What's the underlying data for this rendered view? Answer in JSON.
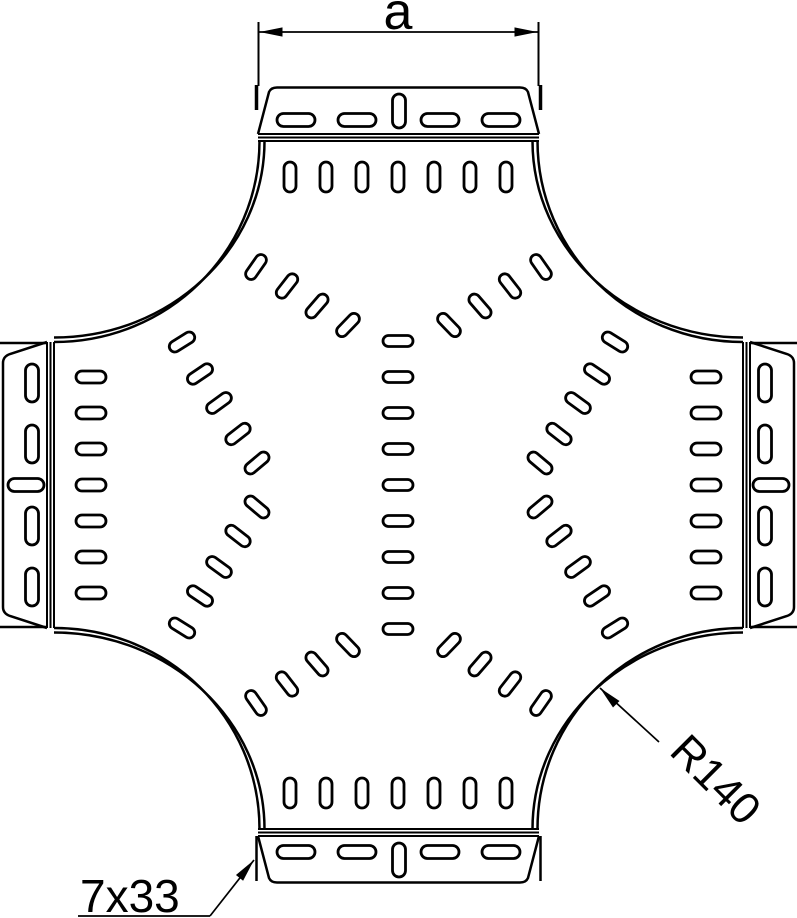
{
  "drawing": {
    "title": "cable-tray-cross-piece-top-view",
    "canvas": {
      "width": 797,
      "height": 918,
      "background": "#ffffff",
      "ink": "#000000"
    },
    "labels": {
      "dim_a": {
        "text": "a",
        "x": 398,
        "y": 29,
        "size": 52,
        "rotate": 0,
        "anchor": "middle"
      },
      "radius": {
        "text": "R140",
        "x": 668,
        "y": 753,
        "size": 44,
        "rotate": 45,
        "anchor": "start"
      },
      "slot_size": {
        "text": "7x33",
        "x": 80,
        "y": 912,
        "size": 46,
        "rotate": 0,
        "anchor": "start"
      }
    },
    "outline": {
      "flange_paths": [
        {
          "name": "top-flange",
          "d": "M 258,134 L 269,92 Q 271,87.5 277,87.5 L 520,87.5 Q 526,87.5 528,92 L 539,134"
        },
        {
          "name": "bottom-flange",
          "d": "M 258,836 L 269,878 Q 271,882.5 277,882.5 L 520,882.5 Q 526,882.5 528,878 L 539,836"
        },
        {
          "name": "left-flange",
          "d": "M 47,342 L 10,354 Q 3,356.5 3,363 L 3,607 Q 3,613.5 10,616 L 47,628"
        },
        {
          "name": "right-flange",
          "d": "M 750,342 L 787,354 Q 794,356.5 794,363 L 794,607 Q 794,613.5 787,616 L 750,628"
        }
      ],
      "fold_lines": [
        {
          "x1": 258,
          "y1": 134,
          "x2": 539,
          "y2": 134
        },
        {
          "x1": 258,
          "y1": 137.5,
          "x2": 539,
          "y2": 137.5
        },
        {
          "x1": 258,
          "y1": 141,
          "x2": 539,
          "y2": 141
        },
        {
          "x1": 258,
          "y1": 829,
          "x2": 539,
          "y2": 829
        },
        {
          "x1": 258,
          "y1": 832.5,
          "x2": 539,
          "y2": 832.5
        },
        {
          "x1": 258,
          "y1": 836,
          "x2": 539,
          "y2": 836
        },
        {
          "x1": 47,
          "y1": 342,
          "x2": 47,
          "y2": 628
        },
        {
          "x1": 50.5,
          "y1": 342,
          "x2": 50.5,
          "y2": 628
        },
        {
          "x1": 54,
          "y1": 342,
          "x2": 54,
          "y2": 628
        },
        {
          "x1": 743,
          "y1": 342,
          "x2": 743,
          "y2": 628
        },
        {
          "x1": 746.5,
          "y1": 342,
          "x2": 746.5,
          "y2": 628
        },
        {
          "x1": 750,
          "y1": 342,
          "x2": 750,
          "y2": 628
        }
      ],
      "corner_arcs": [
        {
          "name": "top-left-outer-arc",
          "d": "M 259.5,141 C 259.5,252 168,342 54,342"
        },
        {
          "name": "top-left-inner-arc",
          "d": "M 264.5,141 C 264.5,249 170,337.5 54,337.5"
        },
        {
          "name": "top-right-outer-arc",
          "d": "M 537.5,141 C 537.5,252 629,342 743,342"
        },
        {
          "name": "top-right-inner-arc",
          "d": "M 532.5,141 C 532.5,249 627,337.5 743,337.5"
        },
        {
          "name": "bottom-left-outer-arc",
          "d": "M 259.5,829 C 259.5,718 168,628 54,628"
        },
        {
          "name": "bottom-left-inner-arc",
          "d": "M 264.5,829 C 264.5,721 170,632.5 54,632.5"
        },
        {
          "name": "bottom-right-outer-arc",
          "d": "M 537.5,829 C 537.5,718 629,628 743,628"
        },
        {
          "name": "bottom-right-inner-arc",
          "d": "M 532.5,829 C 532.5,721 627,632.5 743,632.5"
        }
      ],
      "stub_lines": [
        {
          "x1": 256.5,
          "y1": 85,
          "x2": 256.5,
          "y2": 110,
          "w": 3.5
        },
        {
          "x1": 540.5,
          "y1": 85,
          "x2": 540.5,
          "y2": 110,
          "w": 3.5
        },
        {
          "x1": 256.5,
          "y1": 836,
          "x2": 256.5,
          "y2": 881,
          "w": 2.5
        },
        {
          "x1": 540.5,
          "y1": 836,
          "x2": 540.5,
          "y2": 881,
          "w": 2.5
        },
        {
          "x1": 0,
          "y1": 343,
          "x2": 46,
          "y2": 343,
          "w": 2.5
        },
        {
          "x1": 0,
          "y1": 627,
          "x2": 46,
          "y2": 627,
          "w": 2.5
        },
        {
          "x1": 751,
          "y1": 343,
          "x2": 797,
          "y2": 343,
          "w": 2.5
        },
        {
          "x1": 751,
          "y1": 627,
          "x2": 797,
          "y2": 627,
          "w": 2.5
        }
      ]
    },
    "slot_groups": [
      {
        "name": "top-flange-slots",
        "w": 38,
        "h": 13,
        "pts": [
          [
            296,
            120
          ],
          [
            357,
            120
          ],
          [
            440,
            120
          ],
          [
            501,
            120
          ]
        ]
      },
      {
        "name": "top-flange-center-slot",
        "w": 13,
        "h": 34,
        "pts": [
          [
            399,
            111
          ]
        ]
      },
      {
        "name": "bottom-flange-slots",
        "w": 38,
        "h": 13,
        "pts": [
          [
            296,
            852
          ],
          [
            357,
            852
          ],
          [
            440,
            852
          ],
          [
            501,
            852
          ]
        ]
      },
      {
        "name": "bottom-flange-center-slot",
        "w": 13,
        "h": 34,
        "pts": [
          [
            399,
            860
          ]
        ]
      },
      {
        "name": "left-flange-slots",
        "w": 13,
        "h": 38,
        "pts": [
          [
            32,
            383
          ],
          [
            32,
            444
          ],
          [
            32,
            526
          ],
          [
            32,
            587
          ]
        ]
      },
      {
        "name": "left-flange-center-slot",
        "w": 36,
        "h": 13,
        "pts": [
          [
            26,
            485
          ]
        ]
      },
      {
        "name": "right-flange-slots",
        "w": 13,
        "h": 38,
        "pts": [
          [
            765,
            383
          ],
          [
            765,
            444
          ],
          [
            765,
            526
          ],
          [
            765,
            587
          ]
        ]
      },
      {
        "name": "right-flange-center-slot",
        "w": 36,
        "h": 13,
        "pts": [
          [
            771,
            485
          ]
        ]
      },
      {
        "name": "top-arm-slot-row",
        "w": 12,
        "h": 30,
        "pts": [
          [
            290,
            177
          ],
          [
            326,
            177
          ],
          [
            362,
            177
          ],
          [
            398,
            177
          ],
          [
            434,
            177
          ],
          [
            470,
            177
          ],
          [
            506,
            177
          ]
        ]
      },
      {
        "name": "bottom-arm-slot-row",
        "w": 12,
        "h": 30,
        "pts": [
          [
            290,
            793
          ],
          [
            326,
            793
          ],
          [
            362,
            793
          ],
          [
            398,
            793
          ],
          [
            434,
            793
          ],
          [
            470,
            793
          ],
          [
            506,
            793
          ]
        ]
      },
      {
        "name": "left-arm-slot-column",
        "w": 30,
        "h": 12,
        "pts": [
          [
            91,
            377
          ],
          [
            91,
            413
          ],
          [
            91,
            449
          ],
          [
            91,
            485
          ],
          [
            91,
            521
          ],
          [
            91,
            557
          ],
          [
            91,
            593
          ]
        ]
      },
      {
        "name": "right-arm-slot-column",
        "w": 30,
        "h": 12,
        "pts": [
          [
            706,
            377
          ],
          [
            706,
            413
          ],
          [
            706,
            449
          ],
          [
            706,
            485
          ],
          [
            706,
            521
          ],
          [
            706,
            557
          ],
          [
            706,
            593
          ]
        ]
      },
      {
        "name": "center-slot-column",
        "w": 30,
        "h": 11,
        "pts": [
          [
            398,
            341
          ],
          [
            398,
            377
          ],
          [
            398,
            413
          ],
          [
            398,
            449
          ],
          [
            398,
            485
          ],
          [
            398,
            521
          ],
          [
            398,
            557
          ],
          [
            398,
            593
          ],
          [
            398,
            629
          ]
        ]
      },
      {
        "name": "corner-fan-slots",
        "w": 11,
        "h": 28,
        "pts": [
          [
            256,
            267,
            35
          ],
          [
            287,
            286,
            38
          ],
          [
            317,
            306,
            41
          ],
          [
            348,
            325,
            44
          ],
          [
            182,
            342,
            58
          ],
          [
            200,
            374,
            56
          ],
          [
            219,
            403,
            54
          ],
          [
            238,
            434,
            52
          ],
          [
            257,
            463,
            50
          ],
          [
            541,
            267,
            -35
          ],
          [
            510,
            286,
            -38
          ],
          [
            480,
            306,
            -41
          ],
          [
            449,
            325,
            -44
          ],
          [
            615,
            342,
            -58
          ],
          [
            597,
            374,
            -56
          ],
          [
            578,
            403,
            -54
          ],
          [
            559,
            434,
            -52
          ],
          [
            540,
            463,
            -50
          ],
          [
            256,
            703,
            -35
          ],
          [
            287,
            684,
            -38
          ],
          [
            317,
            664,
            -41
          ],
          [
            348,
            645,
            -44
          ],
          [
            182,
            628,
            -58
          ],
          [
            200,
            596,
            -56
          ],
          [
            219,
            567,
            -54
          ],
          [
            238,
            536,
            -52
          ],
          [
            257,
            507,
            -50
          ],
          [
            541,
            703,
            35
          ],
          [
            510,
            684,
            38
          ],
          [
            480,
            664,
            41
          ],
          [
            449,
            645,
            44
          ],
          [
            615,
            628,
            58
          ],
          [
            597,
            596,
            56
          ],
          [
            578,
            567,
            54
          ],
          [
            559,
            536,
            52
          ],
          [
            540,
            507,
            50
          ]
        ]
      }
    ],
    "dimension": {
      "ext_lines": [
        {
          "x1": 258.5,
          "y1": 22,
          "x2": 258.5,
          "y2": 86
        },
        {
          "x1": 538.5,
          "y1": 22,
          "x2": 538.5,
          "y2": 86
        }
      ],
      "dim_line": {
        "x1": 259.5,
        "y1": 32,
        "x2": 537.5,
        "y2": 32
      },
      "leader_lines": [
        {
          "name": "radius-leader",
          "x1": 600,
          "y1": 688,
          "x2": 659,
          "y2": 742
        },
        {
          "name": "slot-size-underline",
          "x1": 78,
          "y1": 916,
          "x2": 210,
          "y2": 916
        },
        {
          "name": "slot-size-leader",
          "x1": 210,
          "y1": 916,
          "x2": 254,
          "y2": 860
        }
      ],
      "arrows": [
        {
          "name": "dim-a-arrow-left",
          "x": 259.5,
          "y": 32,
          "angle": 180,
          "len": 23,
          "hw": 4.6
        },
        {
          "name": "dim-a-arrow-right",
          "x": 537.5,
          "y": 32,
          "angle": 0,
          "len": 23,
          "hw": 4.6
        },
        {
          "name": "radius-arrow",
          "x": 600,
          "y": 688,
          "angle": -135,
          "len": 23,
          "hw": 4.6
        },
        {
          "name": "slot-size-arrow",
          "x": 254,
          "y": 860,
          "angle": -51,
          "len": 23,
          "hw": 4.6
        }
      ]
    },
    "stroke_widths": {
      "outline": 2.5,
      "fold": 2,
      "slot": 2.8,
      "thin": 1.7
    }
  }
}
